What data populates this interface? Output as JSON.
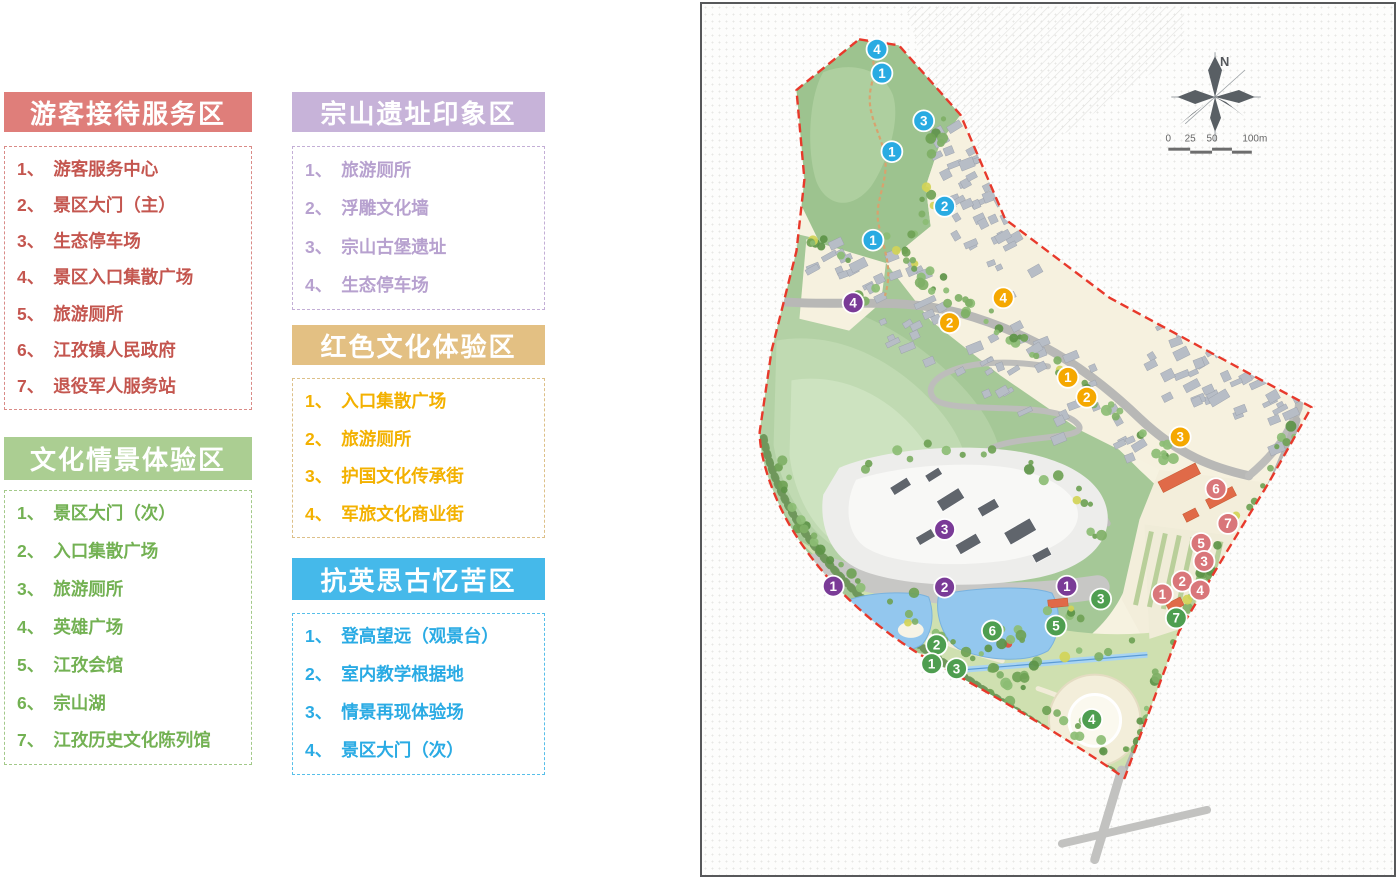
{
  "legend": {
    "numbering_separator": "、",
    "zones": [
      {
        "id": "visitor-service",
        "title": "游客接待服务区",
        "header_bg": "#df7e7a",
        "item_color": "#c4564f",
        "border_color": "#d98b87",
        "marker_color": "#d9767a",
        "items": [
          "游客服务中心",
          "景区大门（主）",
          "生态停车场",
          "景区入口集散广场",
          "旅游厕所",
          "江孜镇人民政府",
          "退役军人服务站"
        ]
      },
      {
        "id": "culture-scene",
        "title": "文化情景体验区",
        "header_bg": "#abce92",
        "item_color": "#73b153",
        "border_color": "#a3c98a",
        "marker_color": "#4e9e50",
        "items": [
          "景区大门（次）",
          "入口集散广场",
          "旅游厕所",
          "英雄广场",
          "江孜会馆",
          "宗山湖",
          "江孜历史文化陈列馆"
        ]
      },
      {
        "id": "zongshan-ruins",
        "title": "宗山遗址印象区",
        "header_bg": "#c7b3d9",
        "item_color": "#b7a1cf",
        "border_color": "#c3aed6",
        "marker_color": "#7a3b97",
        "items": [
          "旅游厕所",
          "浮雕文化墙",
          "宗山古堡遗址",
          "生态停车场"
        ]
      },
      {
        "id": "red-culture",
        "title": "红色文化体验区",
        "header_bg": "#e3c083",
        "item_color": "#f3b100",
        "border_color": "#ddc089",
        "marker_color": "#f5a800",
        "items": [
          "入口集散广场",
          "旅游厕所",
          "护国文化传承街",
          "军旅文化商业街"
        ]
      },
      {
        "id": "anti-british",
        "title": "抗英思古忆苦区",
        "header_bg": "#45b9ea",
        "item_color": "#2aabe4",
        "border_color": "#57bfe9",
        "marker_color": "#29abe2",
        "items": [
          "登高望远（观景台）",
          "室内教学根据地",
          "情景再现体验场",
          "景区大门（次）"
        ]
      }
    ]
  },
  "map": {
    "compass_label": "N",
    "scale_bar": {
      "labels": [
        "0",
        "25",
        "50",
        "100m"
      ]
    },
    "markers": [
      {
        "zone": "anti-british",
        "n": 4,
        "x": 876,
        "y": 47
      },
      {
        "zone": "anti-british",
        "n": 1,
        "x": 881,
        "y": 71
      },
      {
        "zone": "anti-british",
        "n": 3,
        "x": 923,
        "y": 119
      },
      {
        "zone": "anti-british",
        "n": 1,
        "x": 891,
        "y": 150
      },
      {
        "zone": "anti-british",
        "n": 2,
        "x": 944,
        "y": 205
      },
      {
        "zone": "anti-british",
        "n": 1,
        "x": 872,
        "y": 239
      },
      {
        "zone": "zongshan-ruins",
        "n": 4,
        "x": 852,
        "y": 302
      },
      {
        "zone": "red-culture",
        "n": 4,
        "x": 1003,
        "y": 297
      },
      {
        "zone": "red-culture",
        "n": 2,
        "x": 949,
        "y": 322
      },
      {
        "zone": "red-culture",
        "n": 1,
        "x": 1068,
        "y": 377
      },
      {
        "zone": "red-culture",
        "n": 2,
        "x": 1087,
        "y": 397
      },
      {
        "zone": "red-culture",
        "n": 3,
        "x": 1181,
        "y": 437
      },
      {
        "zone": "zongshan-ruins",
        "n": 3,
        "x": 944,
        "y": 530
      },
      {
        "zone": "zongshan-ruins",
        "n": 1,
        "x": 832,
        "y": 587
      },
      {
        "zone": "zongshan-ruins",
        "n": 2,
        "x": 944,
        "y": 588
      },
      {
        "zone": "zongshan-ruins",
        "n": 1,
        "x": 1067,
        "y": 587
      },
      {
        "zone": "visitor-service",
        "n": 6,
        "x": 1217,
        "y": 489
      },
      {
        "zone": "visitor-service",
        "n": 7,
        "x": 1229,
        "y": 524
      },
      {
        "zone": "visitor-service",
        "n": 5,
        "x": 1202,
        "y": 544
      },
      {
        "zone": "visitor-service",
        "n": 3,
        "x": 1205,
        "y": 562
      },
      {
        "zone": "visitor-service",
        "n": 2,
        "x": 1183,
        "y": 582
      },
      {
        "zone": "visitor-service",
        "n": 4,
        "x": 1201,
        "y": 591
      },
      {
        "zone": "visitor-service",
        "n": 1,
        "x": 1163,
        "y": 595
      },
      {
        "zone": "culture-scene",
        "n": 3,
        "x": 1101,
        "y": 600
      },
      {
        "zone": "culture-scene",
        "n": 7,
        "x": 1177,
        "y": 619
      },
      {
        "zone": "culture-scene",
        "n": 5,
        "x": 1056,
        "y": 627
      },
      {
        "zone": "culture-scene",
        "n": 6,
        "x": 992,
        "y": 632
      },
      {
        "zone": "culture-scene",
        "n": 2,
        "x": 936,
        "y": 646
      },
      {
        "zone": "culture-scene",
        "n": 1,
        "x": 931,
        "y": 665
      },
      {
        "zone": "culture-scene",
        "n": 3,
        "x": 956,
        "y": 670
      },
      {
        "zone": "culture-scene",
        "n": 4,
        "x": 1092,
        "y": 721
      }
    ]
  }
}
